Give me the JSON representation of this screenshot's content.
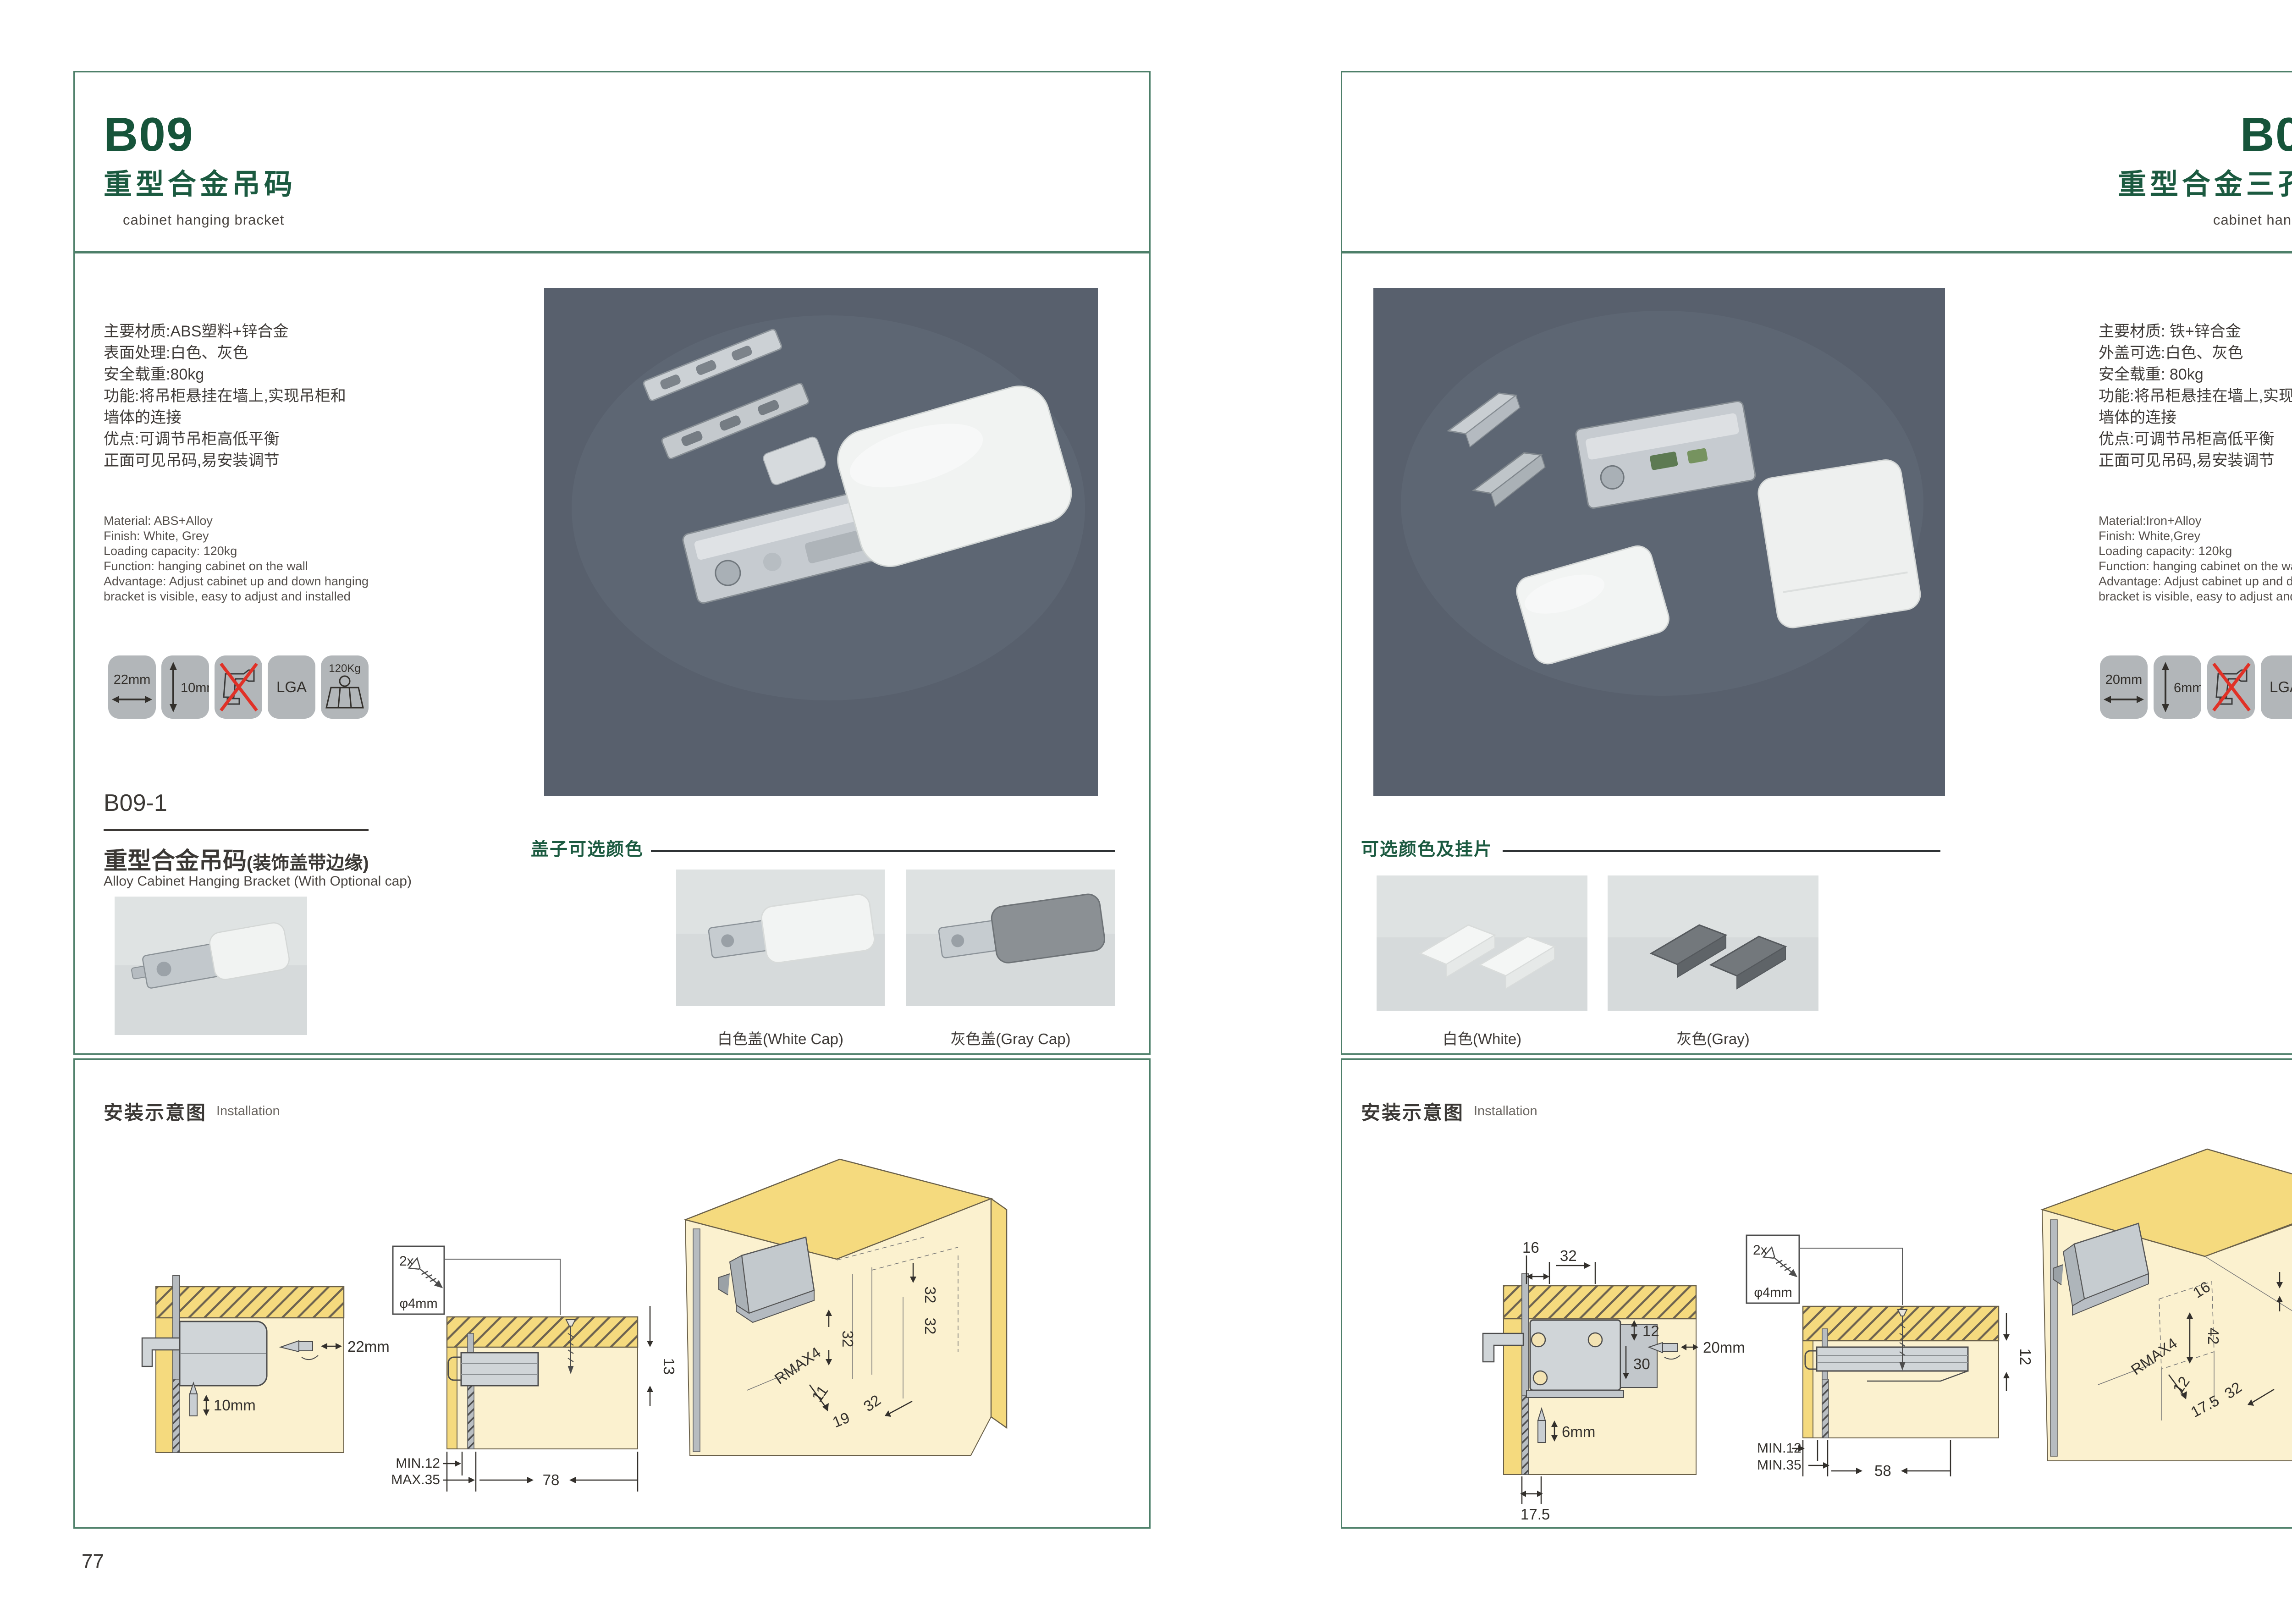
{
  "accent_green": "#1b5a40",
  "border_green": "#4d7f69",
  "photo_bg": "#58606d",
  "page_left": {
    "code": "B09",
    "title_zh": "重型合金吊码",
    "title_en": "cabinet hanging bracket",
    "specs_zh": "主要材质:ABS塑料+锌合金\n表面处理:白色、灰色\n安全载重:80kg\n功能:将吊柜悬挂在墙上,实现吊柜和\n墙体的连接\n优点:可调节吊柜高低平衡\n正面可见吊码,易安装调节",
    "specs_en": "Material: ABS+Alloy\nFinish: White, Grey\nLoading capacity: 120kg\nFunction: hanging cabinet on the wall\nAdvantage: Adjust cabinet up and down hanging\nbracket is visible, easy to adjust and installed",
    "icons": [
      {
        "name": "width-arrow",
        "label": "22mm"
      },
      {
        "name": "height-arrow",
        "label": "10mm"
      },
      {
        "name": "no-drill",
        "label": ""
      },
      {
        "name": "lga",
        "label": "LGA"
      },
      {
        "name": "load",
        "label": "120Kg"
      }
    ],
    "sub": {
      "code": "B09-1",
      "title_zh": "重型合金吊码",
      "title_paren": "(装饰盖带边缘)",
      "title_en": "Alloy Cabinet Hanging Bracket (With Optional cap)"
    },
    "caps": {
      "heading": "盖子可选颜色",
      "options": [
        {
          "label": "白色盖(White Cap)"
        },
        {
          "label": "灰色盖(Gray Cap)"
        }
      ]
    },
    "install": {
      "heading_zh": "安装示意图",
      "heading_en": "Installation",
      "screw_count": "2x",
      "screw_dia": "φ4mm",
      "d1": {
        "h": "22mm",
        "v": "10mm"
      },
      "d2": {
        "depth": "13",
        "min": "MIN.12",
        "max": "MAX.35",
        "w": "78"
      },
      "d3": {
        "t1": "32",
        "t2": "32",
        "mid": "32",
        "rmax": "RMAX4",
        "a": "11",
        "b": "19",
        "c": "32"
      }
    },
    "page_number": "77"
  },
  "page_right": {
    "code": "B09-3",
    "title_zh": "重型合金三孔吊码",
    "title_en": "cabinet hanging bracket",
    "specs_zh": "主要材质: 铁+锌合金\n外盖可选:白色、灰色\n安全载重: 80kg\n功能:将吊柜悬挂在墙上,实现吊柜和\n墙体的连接\n优点:可调节吊柜高低平衡\n正面可见吊码,易安装调节",
    "specs_en": "Material:Iron+Alloy\nFinish: White,Grey\nLoading capacity: 120kg\nFunction: hanging cabinet on the wall\nAdvantage: Adjust cabinet up and down hanging\nbracket is visible, easy to adjust and installed",
    "icons": [
      {
        "name": "width-arrow",
        "label": "20mm"
      },
      {
        "name": "height-arrow",
        "label": "6mm"
      },
      {
        "name": "no-drill",
        "label": ""
      },
      {
        "name": "lga",
        "label": "LGA"
      },
      {
        "name": "load",
        "label": "120Kg"
      }
    ],
    "caps": {
      "heading": "可选颜色及挂片",
      "options": [
        {
          "label": "白色(White)"
        },
        {
          "label": "灰色(Gray)"
        }
      ]
    },
    "install": {
      "heading_zh": "安装示意图",
      "heading_en": "Installation",
      "screw_count": "2x",
      "screw_dia": "φ4mm",
      "d1": {
        "t1": "16",
        "t2": "32",
        "r1": "12",
        "r2": "30",
        "h": "20mm",
        "v": "6mm",
        "b": "17.5"
      },
      "d2": {
        "depth": "12",
        "min": "MIN.12",
        "max": "MIN.35",
        "w": "58"
      },
      "d3": {
        "top": "12",
        "e1": "16",
        "e2": "42",
        "rmax": "RMAX4",
        "a": "12",
        "b": "17.5",
        "c": "32"
      }
    },
    "page_number": "78"
  }
}
